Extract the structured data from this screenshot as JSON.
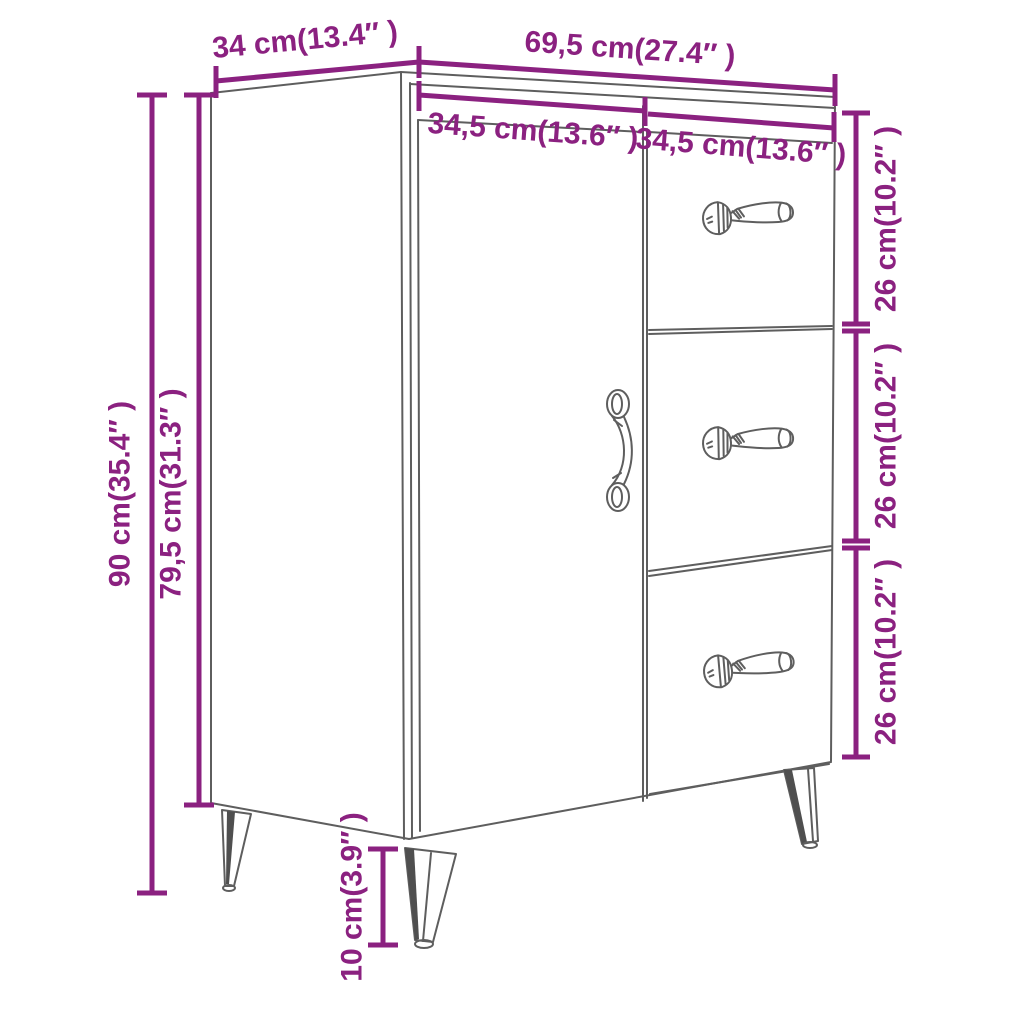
{
  "diagram": {
    "colors": {
      "accent": "#8B2180",
      "line": "#5E5E5E",
      "shade": "#4F4F4F"
    },
    "dimensions": {
      "depth": "34 cm(13.4″ )",
      "width": "69,5 cm(27.4″ )",
      "door_width": "34,5 cm(13.6″ )",
      "drawer_width": "34,5 cm(13.6″ )",
      "total_height": "90 cm(35.4″ )",
      "body_height": "79,5 cm(31.3″ )",
      "drawer1_height": "26 cm(10.2″ )",
      "drawer2_height": "26 cm(10.2″ )",
      "drawer3_height": "26 cm(10.2″ )",
      "leg_height": "10 cm(3.9″ )"
    }
  }
}
